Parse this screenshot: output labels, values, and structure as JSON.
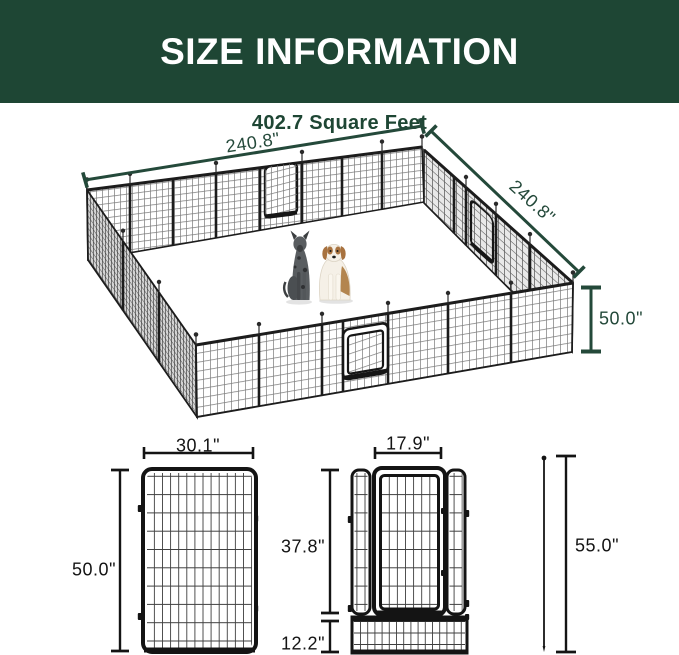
{
  "header": {
    "title": "SIZE INFORMATION"
  },
  "subtitle": "402.7 Square Feet",
  "pen": {
    "width": "240.8\"",
    "depth": "240.8\"",
    "height": "50.0\""
  },
  "panel": {
    "width": "30.1\"",
    "height": "50.0\""
  },
  "gate": {
    "width": "17.9\"",
    "door_height": "37.8\"",
    "base_height": "12.2\"",
    "total_height": "55.0\""
  },
  "colors": {
    "header-bg": "#1e4634",
    "header-text": "#ffffff",
    "accent-green": "#24493a",
    "ink": "#141414"
  }
}
